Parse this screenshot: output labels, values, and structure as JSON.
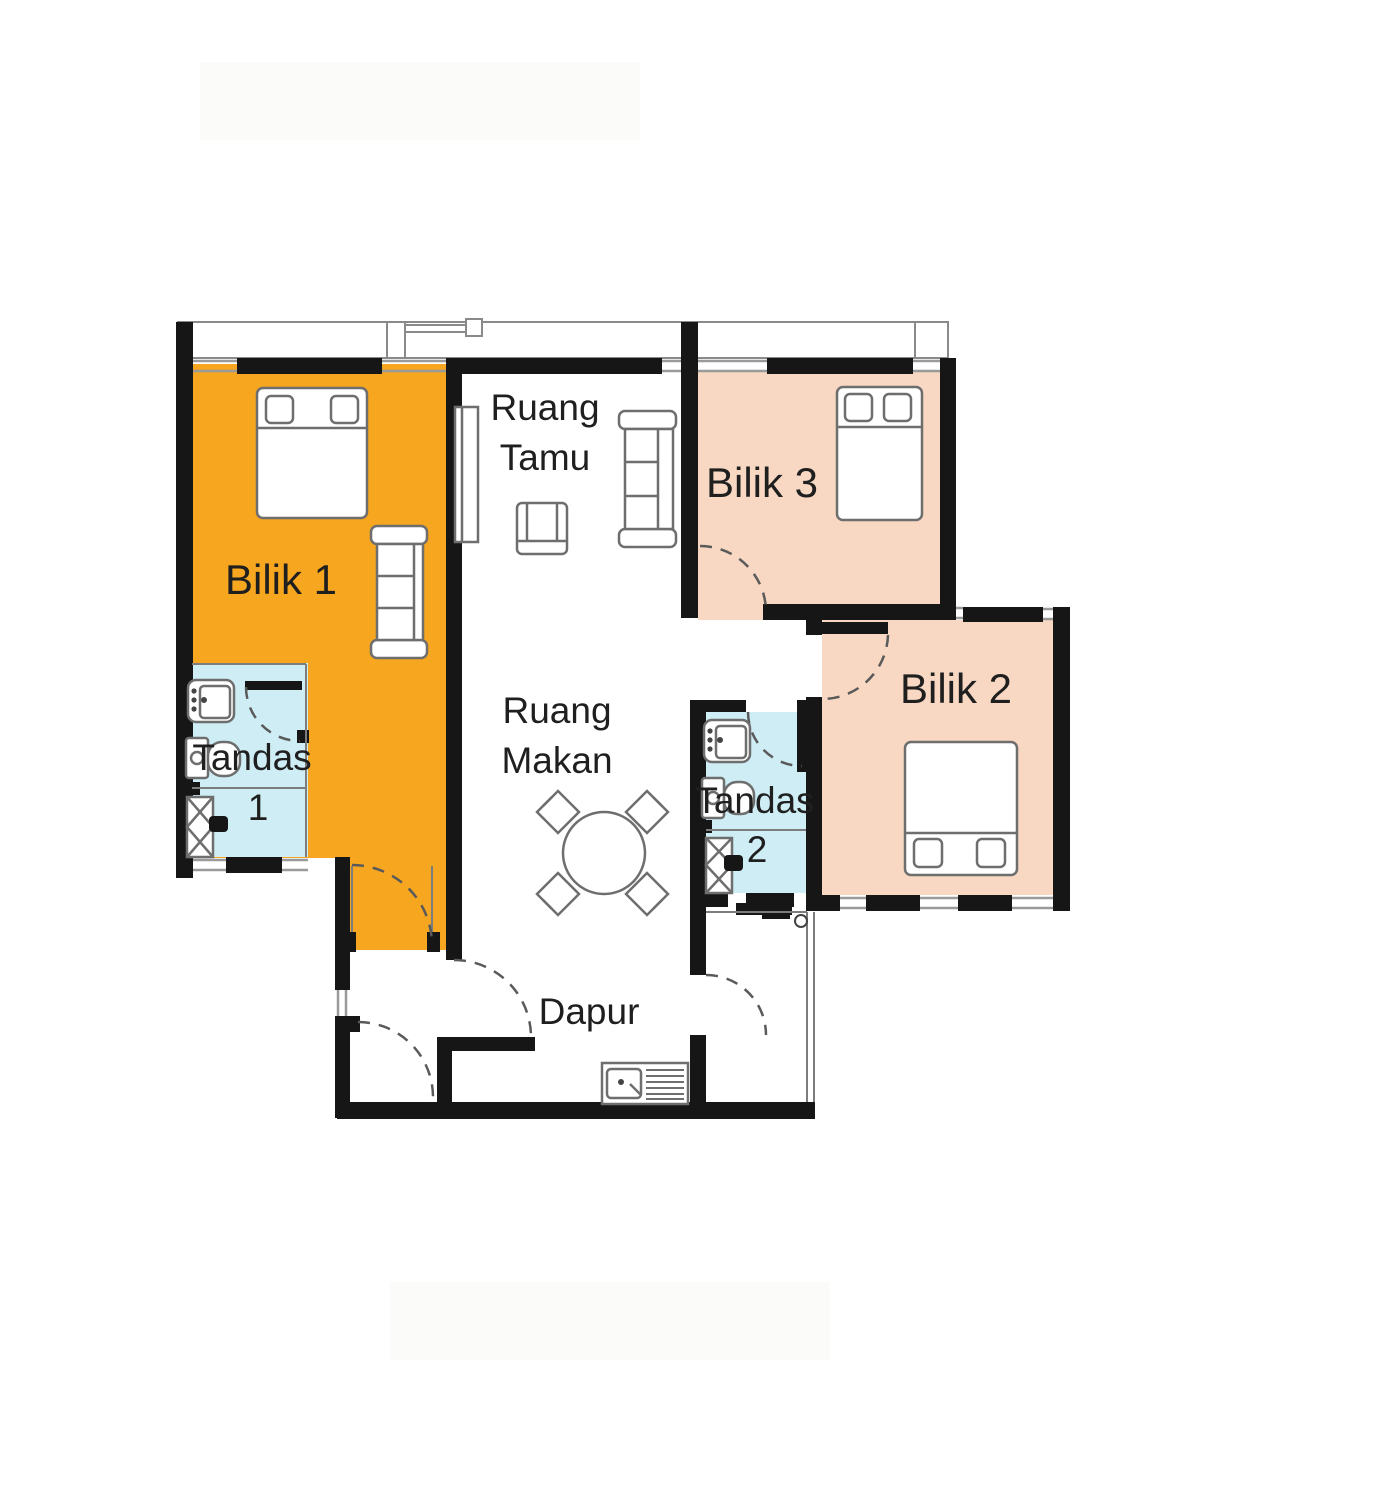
{
  "figure": {
    "type": "apartment floor plan"
  },
  "colors": {
    "bilik1_fill": "#F6A61F",
    "bedroom_fill": "#F8D8C3",
    "bathroom_fill": "#CEEDF5",
    "wall": "#161616",
    "furniture_line": "#6e6e6e",
    "door_line": "#5a5a5a",
    "thin_line": "#9a9a9a",
    "text": "#1f1f1f"
  },
  "rooms": {
    "bilik1": {
      "label": "Bilik 1"
    },
    "bilik2": {
      "label": "Bilik 2"
    },
    "bilik3": {
      "label": "Bilik 3"
    },
    "ruang_tamu": {
      "line1": "Ruang",
      "line2": "Tamu"
    },
    "ruang_makan": {
      "line1": "Ruang",
      "line2": "Makan"
    },
    "dapur": {
      "label": "Dapur"
    },
    "tandas1": {
      "line1": "Tandas",
      "line2": "1"
    },
    "tandas2": {
      "line1": "Tandas",
      "line2": "2"
    }
  }
}
